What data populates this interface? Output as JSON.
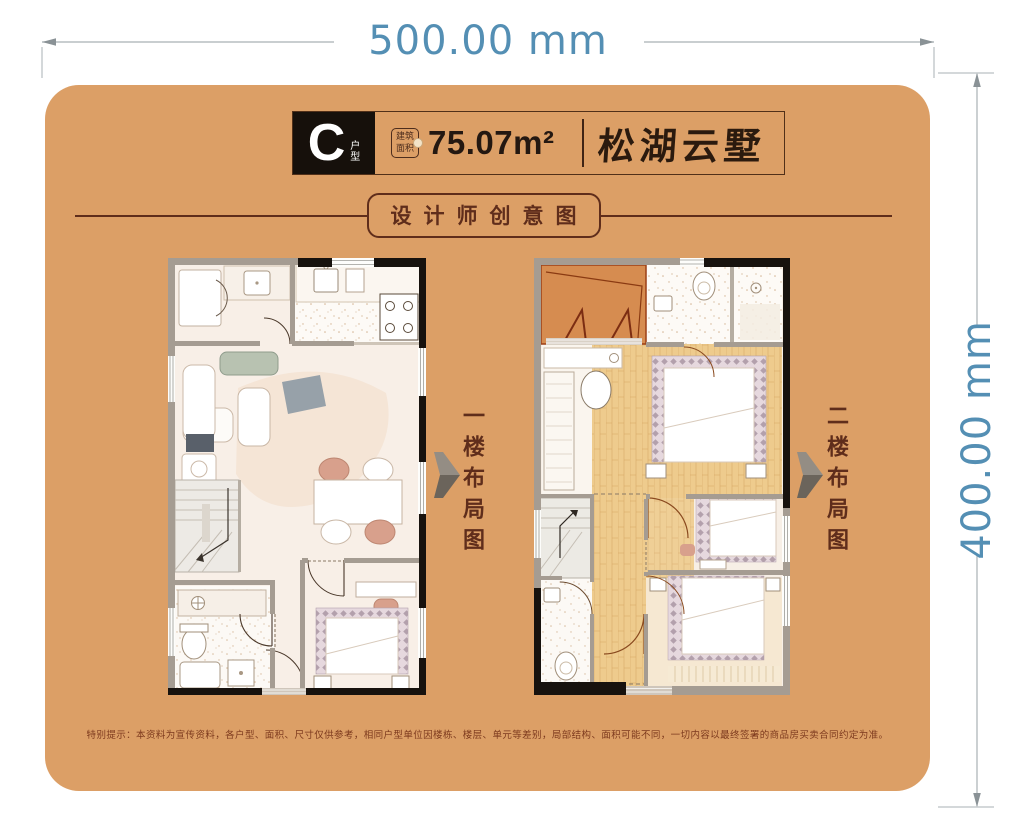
{
  "dimensions": {
    "top_label": "500.00 mm",
    "right_label": "400.00 mm"
  },
  "header": {
    "unit_letter": "C",
    "unit_type_char1": "户",
    "unit_type_char2": "型",
    "area_badge_line1": "建筑",
    "area_badge_line2": "面积",
    "area_value": "75.07m²",
    "brand_name": "松湖云墅"
  },
  "subtitle": "设计师创意图",
  "floor_plans": [
    {
      "label": "一楼布局图"
    },
    {
      "label": "二楼布局图"
    }
  ],
  "disclaimer": "特别提示：本资料为宣传资料，各户型、面积、尺寸仅供参考，相同户型单位因楼栋、楼层、单元等差别，局部结构、面积可能不同，一切内容以最终签署的商品房买卖合同约定为准。",
  "colors": {
    "card_background": "#dc9f66",
    "dimension_text": "#548fb4",
    "dimension_line": "#a9b1b5",
    "accent_dark_brown": "#5f2d1b",
    "wall_black": "#17120e",
    "wall_gray": "#a59c92",
    "wood_floor": "#eecb8d",
    "terrace_orange": "#d68c50",
    "chair_pink": "#d8a08c"
  }
}
